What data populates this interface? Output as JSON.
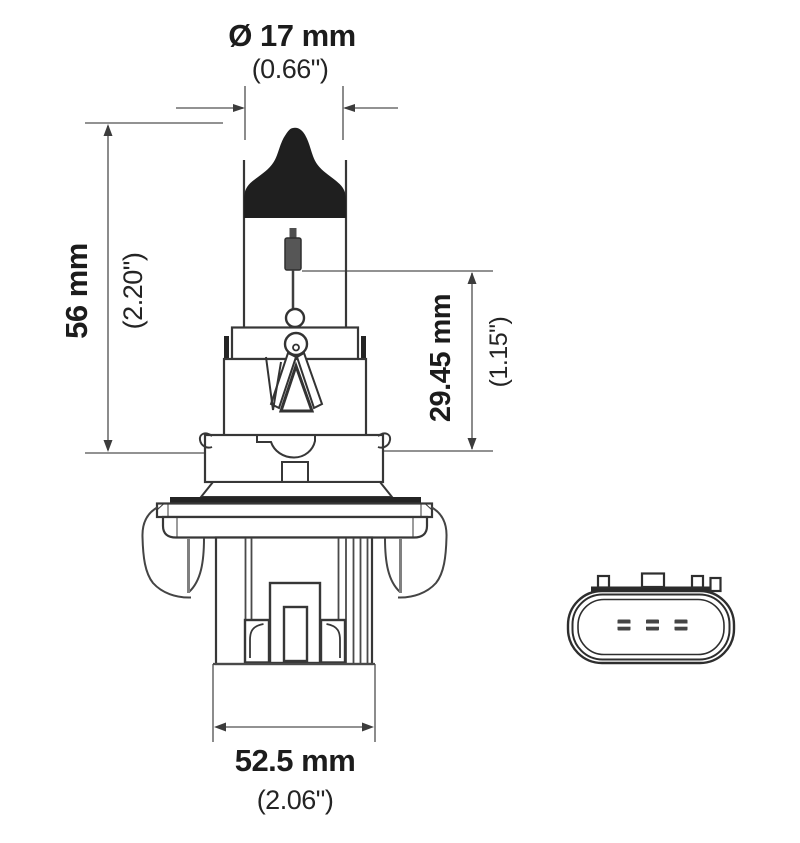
{
  "drawing": {
    "type": "technical-diagram",
    "subject": "halogen bulb with base and connector face",
    "labels": {
      "diameter": {
        "metric": "Ø 17 mm",
        "imperial": "(0.66\")"
      },
      "overall_height": {
        "metric": "56 mm",
        "imperial": "(2.20\")"
      },
      "light_center_length": {
        "metric": "29.45 mm",
        "imperial": "(1.15\")"
      },
      "base_width": {
        "metric": "52.5 mm",
        "imperial": "(2.06\")"
      }
    },
    "colors": {
      "outline": "#373737",
      "heavy_fill": "#242424",
      "dimension_line": "#6f6f6f",
      "text": "#1c1c1c",
      "filament_fill": "#565656",
      "background": "#ffffff"
    }
  }
}
